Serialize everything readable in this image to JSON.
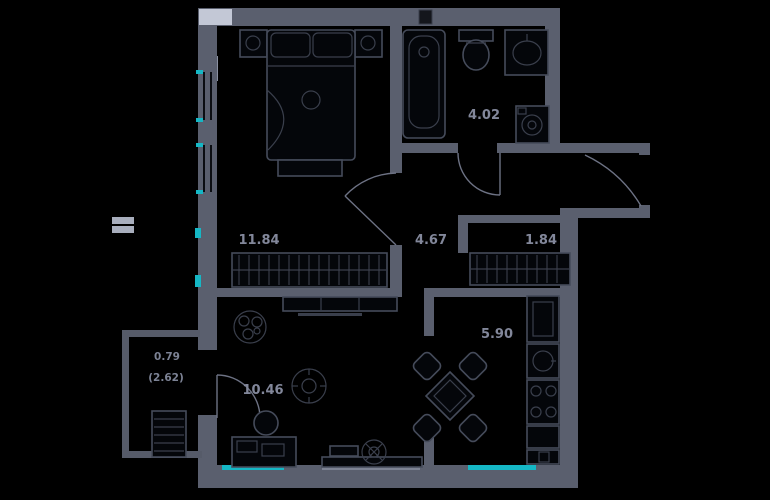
{
  "plan": {
    "type": "apartment-floor-plan",
    "background_color": "#000000",
    "wall_color": "#5a5f6e",
    "balcony_wall_color": "#565b69",
    "window_accent_color": "#15b7c5",
    "label_color": "#82879a",
    "furniture_line_color": "#454b5a",
    "rooms": [
      {
        "id": "bedroom",
        "area_label": "11.84"
      },
      {
        "id": "bathroom",
        "area_label": "4.02"
      },
      {
        "id": "hallway",
        "area_label": "4.67"
      },
      {
        "id": "closet",
        "area_label": "1.84"
      },
      {
        "id": "living-room",
        "area_label": "10.46"
      },
      {
        "id": "kitchen",
        "area_label": "5.90"
      },
      {
        "id": "balcony",
        "area_label": "0.79",
        "area_label_full": "(2.62)"
      }
    ],
    "icons": [
      "double-bed-icon",
      "nightstand-icon",
      "wardrobe-icon",
      "bench-icon",
      "bathtub-icon",
      "toilet-icon",
      "washbasin-icon",
      "washing-machine-icon",
      "vent-shaft-icon",
      "fridge-icon",
      "kitchen-sink-icon",
      "stove-icon",
      "kitchen-counter-icon",
      "dining-table-icon",
      "chair-icon",
      "desk-icon",
      "desk-chair-icon",
      "monitor-icon",
      "tv-icon",
      "tv-stand-icon",
      "plant-icon",
      "ceiling-light-icon",
      "drying-rack-icon",
      "door-swing-arc",
      "window-teal-marker"
    ]
  }
}
